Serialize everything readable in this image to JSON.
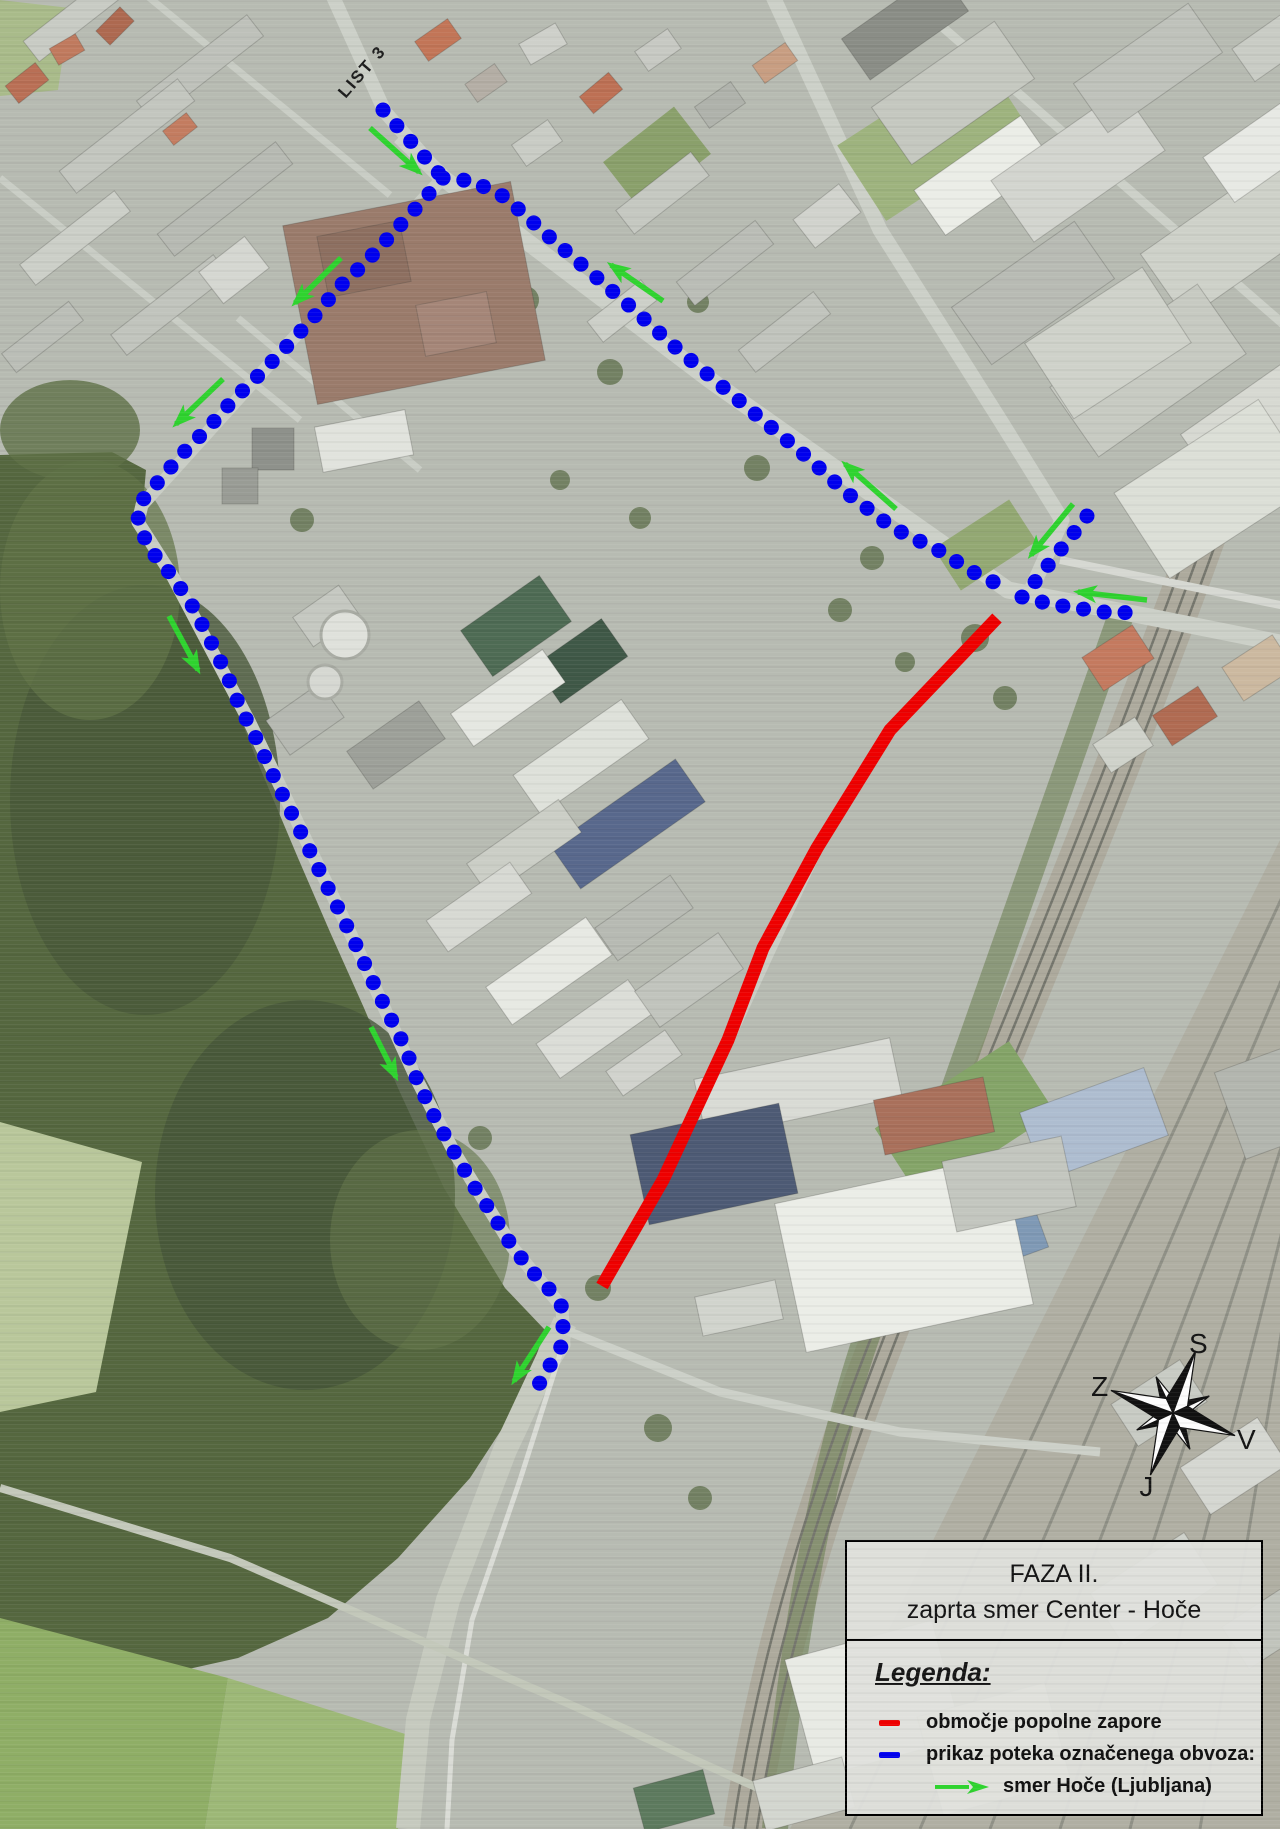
{
  "map": {
    "sheet_label": "LIST 3",
    "colors": {
      "closure": "#ee0000",
      "detour": "#0000ee",
      "direction": "#2fd32f"
    },
    "compass": {
      "labels": {
        "north": "S",
        "east": "V",
        "south": "J",
        "west": "Z"
      },
      "rotation_deg": 20,
      "center": [
        1173,
        1413
      ]
    },
    "routes": {
      "closure": {
        "meaning": "območje popolne zapore",
        "points": [
          [
            997,
            618
          ],
          [
            890,
            730
          ],
          [
            817,
            848
          ],
          [
            763,
            948
          ],
          [
            728,
            1040
          ],
          [
            663,
            1180
          ],
          [
            602,
            1286
          ]
        ]
      },
      "detour_segments": [
        {
          "name": "north-approach",
          "points": [
            [
              383,
              110
            ],
            [
              443,
              178
            ]
          ]
        },
        {
          "name": "trzaska-leg",
          "points": [
            [
              443,
              178
            ],
            [
              472,
              181
            ],
            [
              505,
              197
            ],
            [
              546,
              234
            ],
            [
              589,
              271
            ],
            [
              632,
              308
            ],
            [
              675,
              347
            ],
            [
              718,
              383
            ],
            [
              760,
              418
            ],
            [
              807,
              457
            ],
            [
              847,
              493
            ],
            [
              893,
              528
            ],
            [
              938,
              550
            ],
            [
              975,
              573
            ],
            [
              1008,
              589
            ]
          ]
        },
        {
          "name": "east-arm",
          "points": [
            [
              1022,
              597
            ],
            [
              1042,
              602
            ],
            [
              1063,
              606
            ],
            [
              1083,
              609
            ],
            [
              1102,
              612
            ],
            [
              1140,
              613
            ]
          ]
        },
        {
          "name": "northeast-arm",
          "points": [
            [
              1087,
              516
            ],
            [
              1073,
              534
            ],
            [
              1062,
              548
            ],
            [
              1050,
              563
            ],
            [
              1037,
              579
            ],
            [
              1026,
              594
            ]
          ]
        },
        {
          "name": "southwest-leg",
          "points": [
            [
              443,
              178
            ],
            [
              417,
              207
            ],
            [
              391,
              235
            ],
            [
              365,
              263
            ],
            [
              339,
              287
            ],
            [
              313,
              318
            ],
            [
              288,
              345
            ],
            [
              262,
              372
            ],
            [
              233,
              400
            ],
            [
              209,
              427
            ],
            [
              183,
              453
            ],
            [
              158,
              482
            ],
            [
              140,
              503
            ],
            [
              138,
              520
            ],
            [
              148,
              547
            ],
            [
              173,
              577
            ],
            [
              193,
              607
            ],
            [
              210,
              640
            ],
            [
              227,
              675
            ],
            [
              240,
              707
            ],
            [
              257,
              740
            ],
            [
              273,
              775
            ],
            [
              290,
              810
            ],
            [
              307,
              845
            ],
            [
              323,
              878
            ],
            [
              340,
              912
            ],
            [
              357,
              947
            ],
            [
              372,
              980
            ],
            [
              388,
              1013
            ],
            [
              405,
              1047
            ],
            [
              417,
              1080
            ],
            [
              435,
              1118
            ],
            [
              453,
              1150
            ],
            [
              473,
              1185
            ],
            [
              493,
              1215
            ],
            [
              513,
              1248
            ],
            [
              537,
              1277
            ],
            [
              550,
              1290
            ],
            [
              562,
              1307
            ],
            [
              563,
              1327
            ],
            [
              562,
              1345
            ],
            [
              552,
              1362
            ],
            [
              543,
              1377
            ],
            [
              533,
              1395
            ]
          ]
        }
      ],
      "direction_arrows": [
        {
          "tail": [
            370,
            128
          ],
          "head": [
            419,
            172
          ]
        },
        {
          "tail": [
            341,
            258
          ],
          "head": [
            295,
            303
          ]
        },
        {
          "tail": [
            223,
            379
          ],
          "head": [
            176,
            424
          ]
        },
        {
          "tail": [
            169,
            616
          ],
          "head": [
            198,
            670
          ]
        },
        {
          "tail": [
            371,
            1027
          ],
          "head": [
            396,
            1077
          ]
        },
        {
          "tail": [
            549,
            1327
          ],
          "head": [
            514,
            1381
          ]
        },
        {
          "tail": [
            663,
            301
          ],
          "head": [
            611,
            265
          ]
        },
        {
          "tail": [
            896,
            509
          ],
          "head": [
            845,
            464
          ]
        },
        {
          "tail": [
            1073,
            504
          ],
          "head": [
            1031,
            555
          ]
        },
        {
          "tail": [
            1147,
            600
          ],
          "head": [
            1078,
            592
          ]
        }
      ]
    }
  },
  "legend_panel": {
    "title_line1": "FAZA II.",
    "title_line2": "zaprta smer Center - Hoče",
    "legend_heading": "Legenda:",
    "items": [
      {
        "swatch": "closure-line",
        "label": "območje popolne zapore"
      },
      {
        "swatch": "detour-dash",
        "label": "prikaz poteka označenega obvoza:"
      },
      {
        "swatch": "direction-arrow",
        "label": "smer Hoče (Ljubljana)"
      }
    ]
  }
}
